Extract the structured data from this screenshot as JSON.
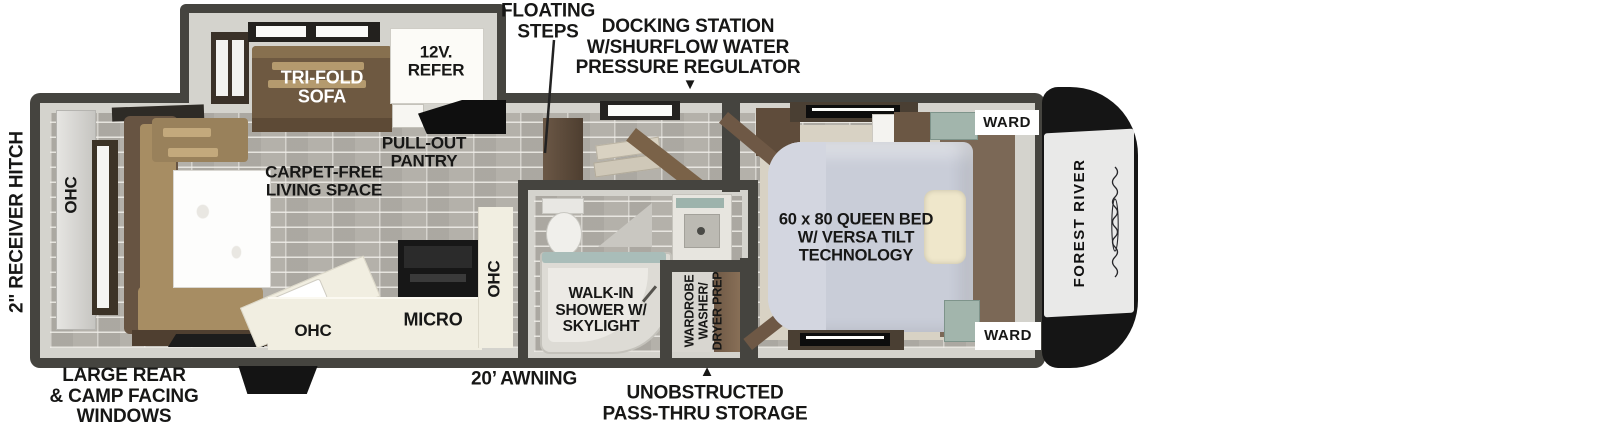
{
  "floorplan": {
    "brand": "FOREST RIVER",
    "exterior": {
      "receiver_hitch": "2\" RECEIVER HITCH",
      "floating_steps": "FLOATING\nSTEPS",
      "docking_station": "DOCKING STATION\nW/SHURFLOW WATER\nPRESSURE REGULATOR",
      "docking_arrow": "▼",
      "rear_windows": "LARGE REAR\n& CAMP FACING\nWINDOWS",
      "awning": "20’ AWNING",
      "pass_thru_arrow": "▲",
      "pass_thru": "UNOBSTRUCTED\nPASS-THRU STORAGE"
    },
    "living": {
      "sofa": "TRI-FOLD\nSOFA",
      "refrigerator": "12V.\nREFER",
      "pantry": "PULL-OUT\nPANTRY",
      "carpet_free": "CARPET-FREE\nLIVING SPACE",
      "ohc_rear": "OHC"
    },
    "kitchen": {
      "ohc_counter": "OHC",
      "micro": "MICRO",
      "ohc_wall": "OHC"
    },
    "bathroom": {
      "shower": "WALK-IN\nSHOWER W/\nSKYLIGHT",
      "wardrobe": "WARDROBE\nWASHER/\nDRYER PREP"
    },
    "bedroom": {
      "bed": "60 x 80 QUEEN BED\nW/ VERSA TILT\nTECHNOLOGY",
      "ward_top": "WARD",
      "ward_bottom": "WARD"
    },
    "colors": {
      "wall": "#45443f",
      "lining": "#d4d3cd",
      "floor": "#b4b1aa",
      "sofa_brown": "#6e5941",
      "dinette_tan": "#a78d63",
      "bed_gray": "#c9cdd8",
      "pillow_cream": "#efe7cb",
      "counter_cream": "#f1eee1",
      "cap_black": "#151515",
      "accent_teal": "#a2b5ac"
    }
  }
}
